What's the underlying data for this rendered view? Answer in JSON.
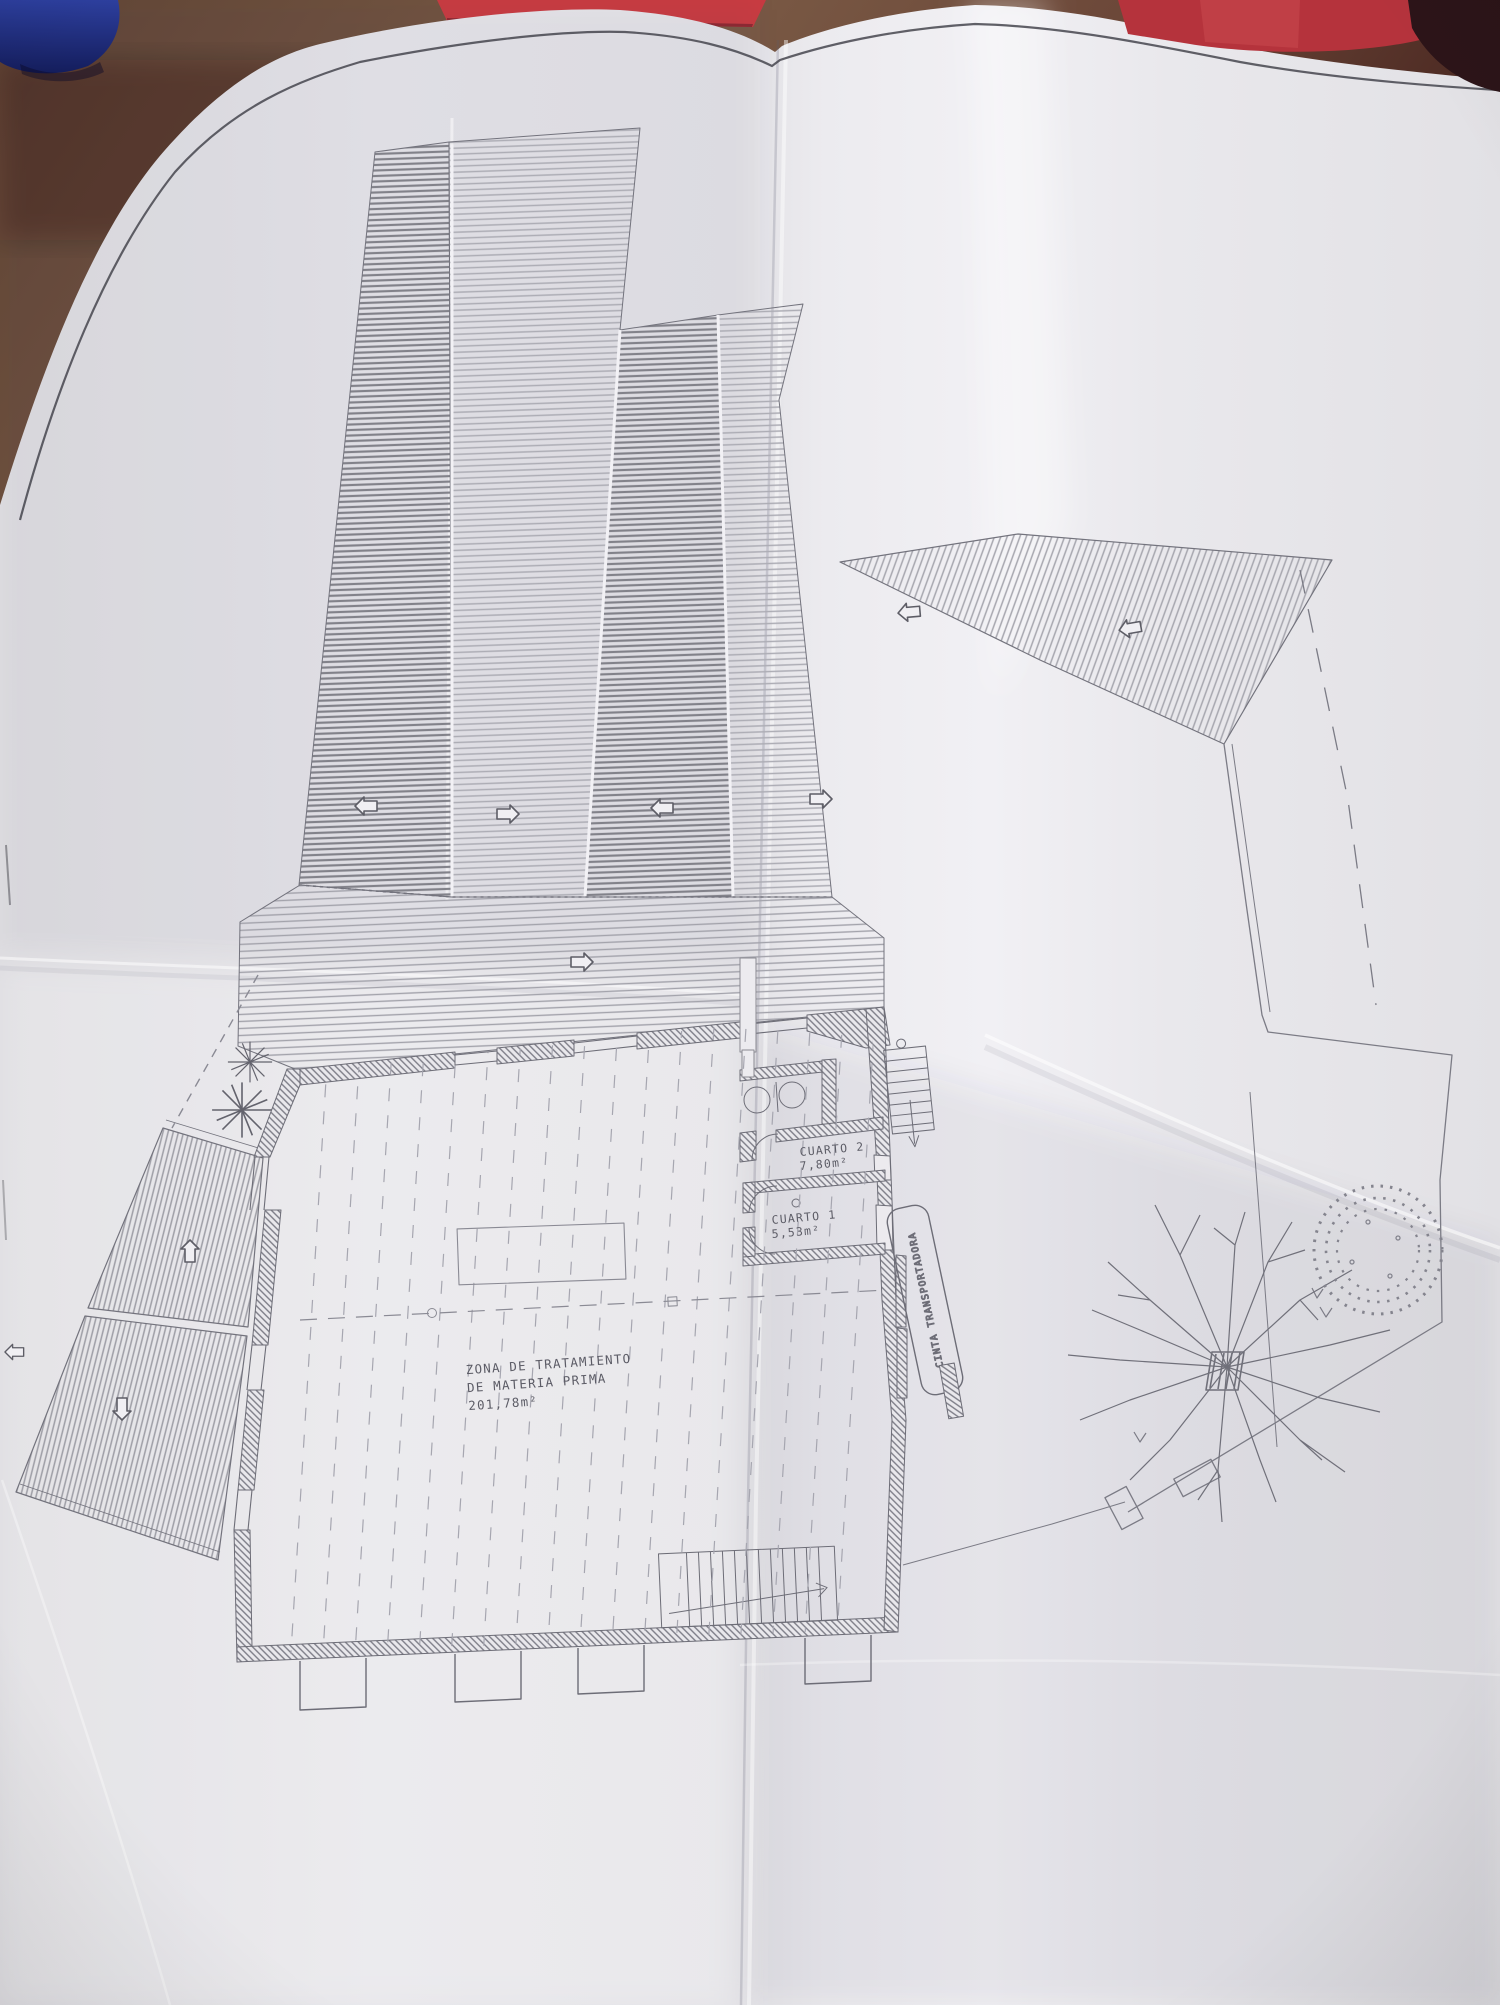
{
  "scene": {
    "description_labels": {
      "conveyor_label": "CINTA TRANSPORTADORA"
    },
    "colors": {
      "table_wood": "#6b4a39",
      "blue_object": "#26348c",
      "red_object": "#c23a40",
      "dark_corner_object": "#2c1418",
      "paper": "#e9e8ec",
      "ink": "#60606a",
      "hatch_dark": "#7d7d85",
      "hatch_light": "#a9a9b1"
    }
  },
  "plan": {
    "treatment_zone": {
      "line1": "ZONA DE TRATAMIENTO",
      "line2": "DE MATERIA PRIMA",
      "area": "201,78m²"
    },
    "rooms": [
      {
        "name": "CUARTO 2",
        "area": "7,80m²"
      },
      {
        "name": "CUARTO 1",
        "area": "5,53m²"
      }
    ],
    "conveyor_label": "CINTA TRANSPORTADORA"
  }
}
